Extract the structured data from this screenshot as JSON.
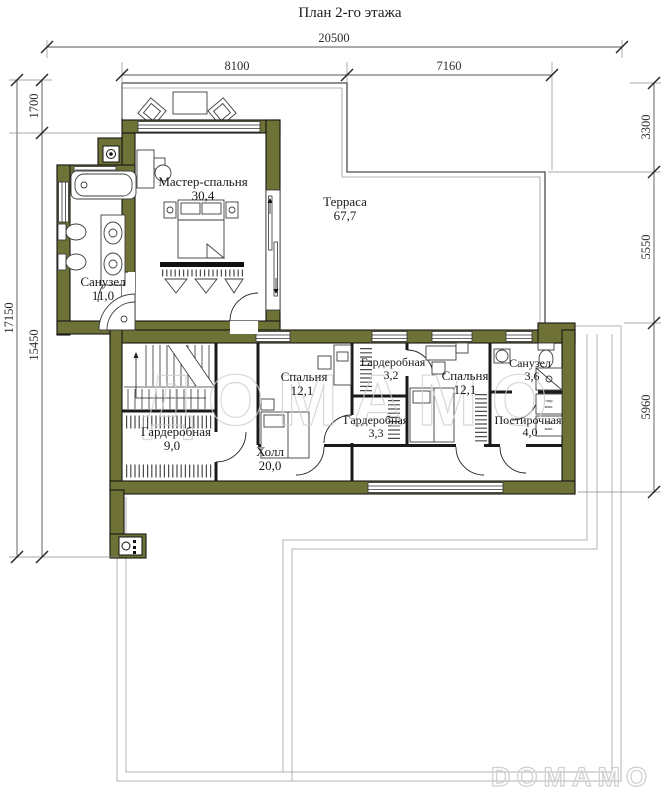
{
  "title": "План 2-го этажа",
  "watermark": "ДОМАМО",
  "logo": "DOMAMO",
  "dims": {
    "total_width": "20500",
    "width_left": "8100",
    "width_right": "7160",
    "left_top": "1700",
    "left_total": "17150",
    "left_main": "15450",
    "right_top": "3300",
    "right_mid": "5550",
    "right_bottom": "5960"
  },
  "rooms": {
    "master": {
      "name": "Мастер-спальня",
      "area": "30,4"
    },
    "terrace": {
      "name": "Терраса",
      "area": "67,7"
    },
    "bath_main": {
      "name": "Санузел",
      "area": "11,0"
    },
    "wardrobe_big": {
      "name": "Гардеробная",
      "area": "9,0"
    },
    "hall": {
      "name": "Холл",
      "area": "20,0"
    },
    "bedroom_left": {
      "name": "Спальня",
      "area": "12,1"
    },
    "wardrobe_32": {
      "name": "Гардеробная",
      "area": "3,2"
    },
    "wardrobe_33": {
      "name": "Гардеробная",
      "area": "3,3"
    },
    "bedroom_right": {
      "name": "Спальня",
      "area": "12,1"
    },
    "bath_small": {
      "name": "Санузел",
      "area": "3,6"
    },
    "laundry": {
      "name": "Постирочная",
      "area": "4,0"
    }
  },
  "appliances": {
    "washer_line1": "стир.",
    "washer_line2": "маш.",
    "dryer_line1": "суш.",
    "dryer_line2": "маш."
  },
  "colors": {
    "wall": "#6e7237"
  }
}
